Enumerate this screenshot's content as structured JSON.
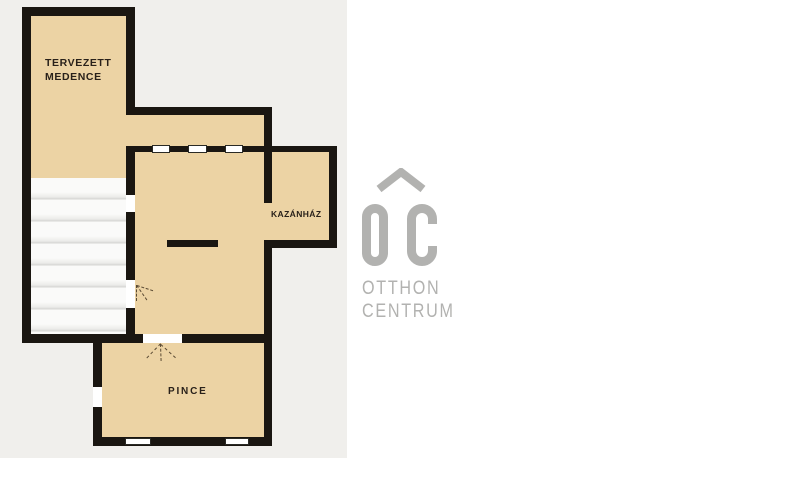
{
  "colors": {
    "wall": "#1a1611",
    "room": "#ecd3a4",
    "panel": "#f0efec",
    "logo": "#b2b2b0",
    "label": "#29211a"
  },
  "floorplan": {
    "rooms": {
      "pool": {
        "lines": [
          "TERVEZETT",
          "MEDENCE"
        ]
      },
      "boiler": {
        "label": "KAZÁNHÁZ"
      },
      "cellar": {
        "label": "PINCE"
      }
    }
  },
  "logo": {
    "monogram": "OC",
    "line1": "OTTHON",
    "line2": "CENTRUM"
  }
}
